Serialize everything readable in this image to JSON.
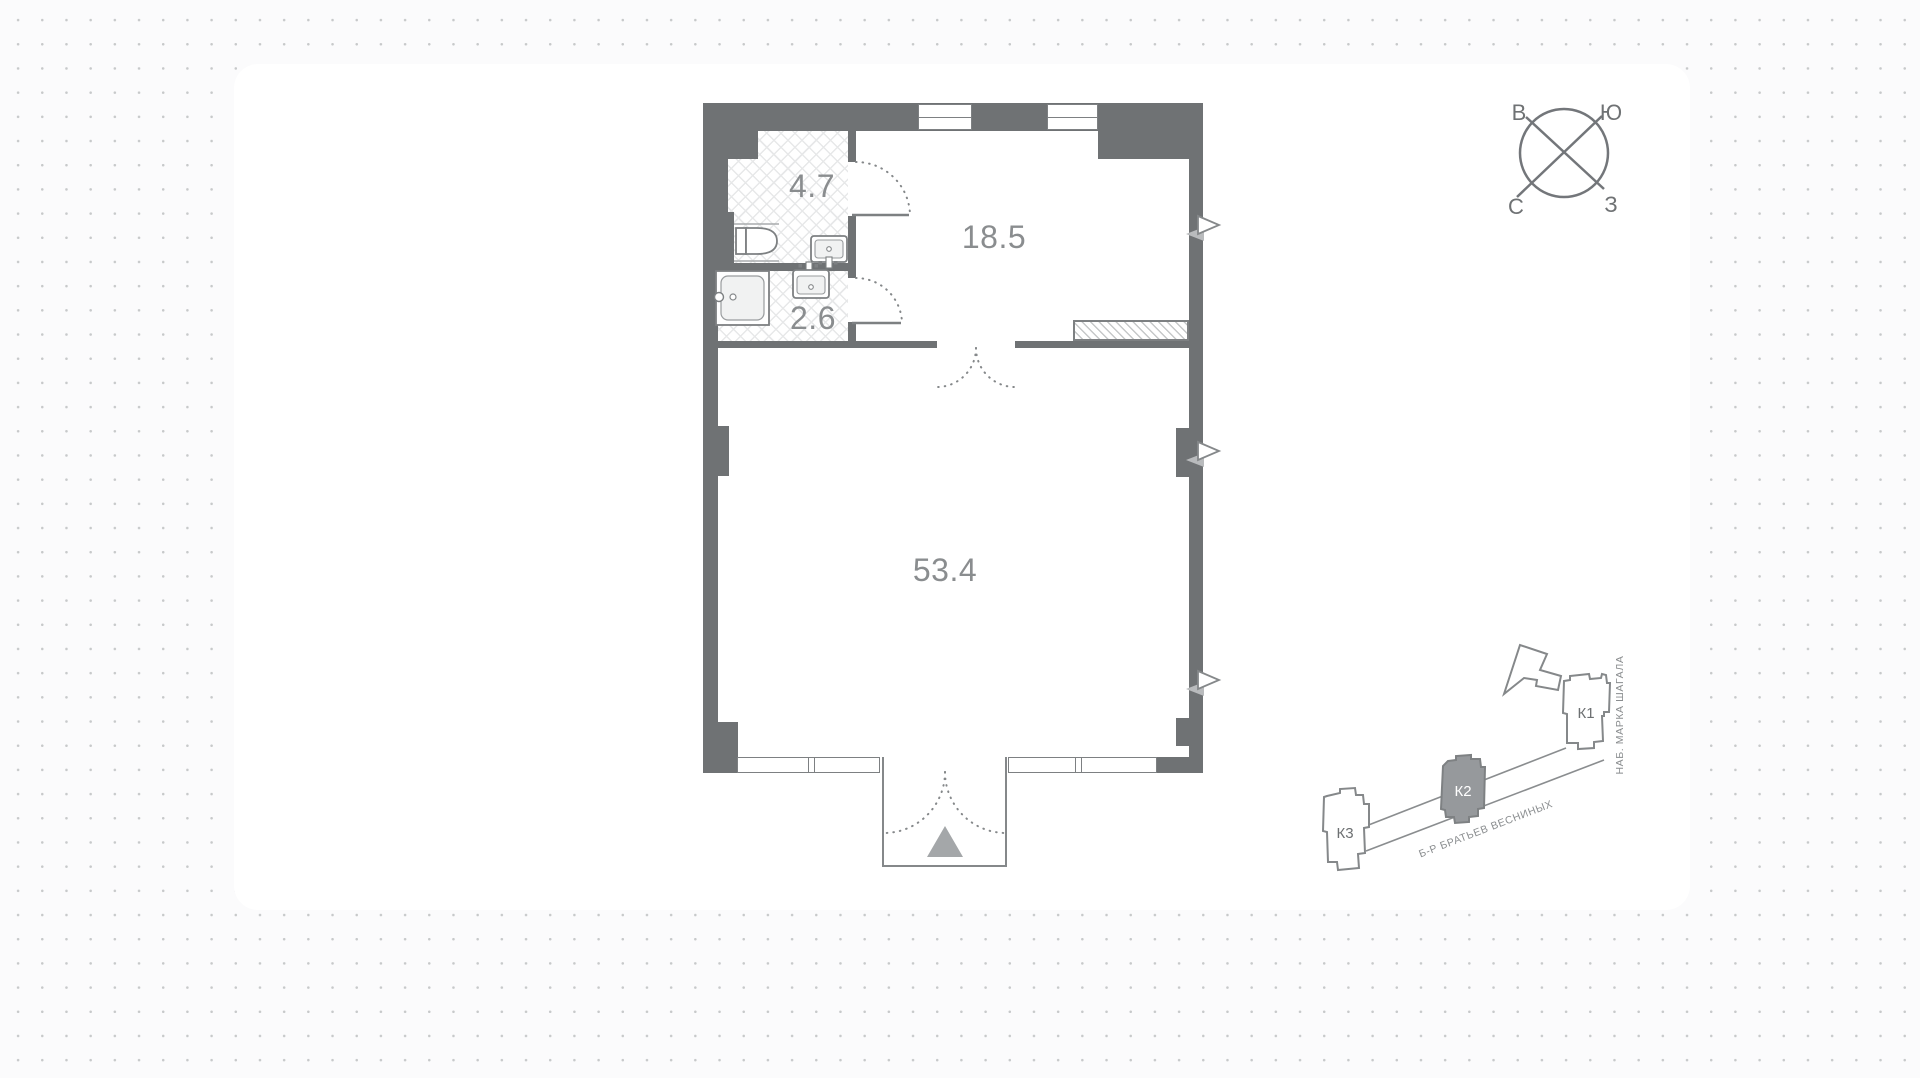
{
  "floor_plan": {
    "rooms": [
      {
        "name": "bathroom",
        "area": "4.7"
      },
      {
        "name": "wc",
        "area": "2.6"
      },
      {
        "name": "hallway",
        "area": "18.5"
      },
      {
        "name": "living-space",
        "area": "53.4"
      }
    ],
    "wall_color": "#6f7274",
    "line_color": "#7d8082",
    "label_color": "#8a8d8f"
  },
  "compass": {
    "top_left": "В",
    "top_right": "Ю",
    "bottom_left": "С",
    "bottom_right": "З"
  },
  "site_plan": {
    "buildings": [
      {
        "label": "К1",
        "highlighted": false
      },
      {
        "label": "К2",
        "highlighted": true
      },
      {
        "label": "К3",
        "highlighted": false
      }
    ],
    "streets": {
      "embankment": "НАБ. МАРКА ШАГАЛА",
      "boulevard": "Б-Р БРАТЬЕВ ВЕСНИНЫХ"
    },
    "highlight_color": "#96999c"
  }
}
